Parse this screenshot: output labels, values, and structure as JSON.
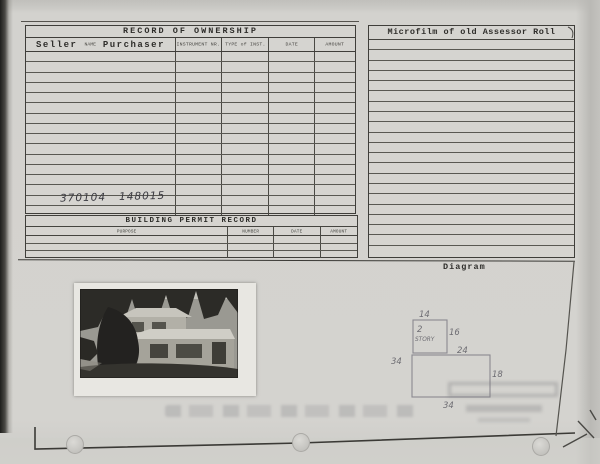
{
  "ownership": {
    "title": "RECORD OF OWNERSHIP",
    "seller_label": "Seller",
    "name_label": "NAME",
    "purchaser_label": "Purchaser",
    "col_instrument": "INSTRUMENT NR.",
    "col_type": "TYPE of INST.",
    "col_date": "DATE",
    "col_amount": "AMOUNT",
    "rows_count": 16,
    "handwritten_entry": "370104   148015"
  },
  "microfilm": {
    "title": "Microfilm of old Assessor Roll",
    "lines_count": 21
  },
  "permit": {
    "title": "BUILDING PERMIT RECORD",
    "col_purpose": "PURPOSE",
    "col_number": "NUMBER",
    "col_date": "DATE",
    "col_amount": "AMOUNT",
    "rows_count": 3
  },
  "diagram": {
    "label": "Diagram",
    "dims": {
      "upper_width": "14",
      "story_count": "2",
      "story_word": "STORY",
      "upper_depth": "16",
      "step_width": "24",
      "left_width": "34",
      "right_depth": "18",
      "bottom_width": "34"
    }
  }
}
